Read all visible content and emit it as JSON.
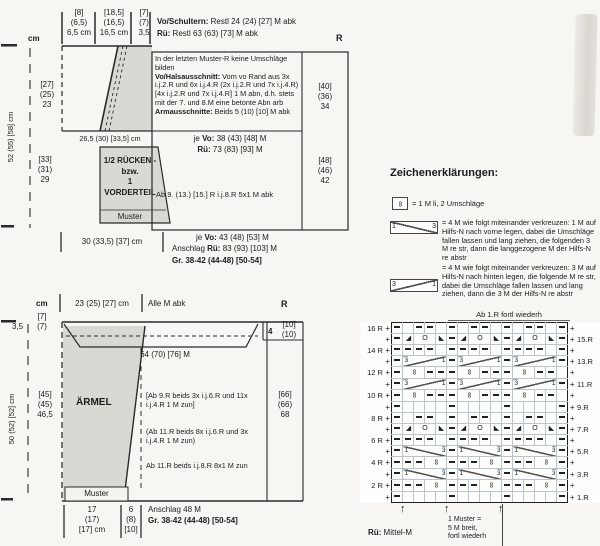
{
  "back": {
    "cm": "cm",
    "measure1": "[8]\n(6,5)\n6,5 cm",
    "measure2": "[18,5]\n(16,5)\n16,5 cm",
    "measure3": "[7]\n(7)\n3,5",
    "shoulder1_b": "Vo/Schultern:",
    "shoulder1_t": " Restl 24 (24) [27] M abk",
    "shoulder2_b": "Rü:",
    "shoulder2_t": " Restl 63 (63) [73] M abk",
    "r_header": "R",
    "rows_upper": "[27]\n(25)\n23",
    "rows_lower": "[33]\n(31)\n29",
    "side_cm": "52 (55) [58] cm",
    "mid_width": "26,5 (30) [33,5] cm",
    "piece_label": "1/2 RÜCKEN -\nbzw.\n1 VORDERTEIL",
    "muster": "Muster",
    "note1": "In der letzten Muster-R keine Umschläge bilden",
    "note2_b": "Vo/Halsausschnitt:",
    "note2_t": " Vom vo Rand aus 3x i.j.2.R und 6x i.j.4.R (2x i.j.2.R und 7x i.j.4.R) [4x i.j.2.R und 7x i.j.4.R] 1 M abn, d.h. stets mit der 7. und 8.M eine betonte Abn arb",
    "note3_b": "Armausschnitte:",
    "note3_t": " Beids 5 (10) [10] M abk",
    "counts_upper": "[40]\n(36)\n34",
    "sts_vo_pre": "je ",
    "sts_vo_b": "Vo:",
    "sts_vo_t": " 38 (43) [48] M",
    "sts_rue_b": "Rü:",
    "sts_rue_t": " 73 (83) [93] M",
    "bindoff_line": "Ab 9. (13.) [15.] R i.j.8.R 5x1 M abk",
    "counts_lower": "[48]\n(46)\n42",
    "bottom_width": "30 (33,5) [37] cm",
    "cast_vo_pre": "je ",
    "cast_vo_b": "Vo:",
    "cast_vo_t": " 43 (48) [53] M",
    "cast_rue_pre": "Anschlag  ",
    "cast_rue_b": "Rü:",
    "cast_rue_t": " 83 (93) [103] M",
    "sizes": "Gr. 38-42 (44-48) [50-54]"
  },
  "sleeve": {
    "cm": "cm",
    "top_width": "23 (25) [27] cm",
    "alle_abk": "Alle M abk",
    "r_header": "R",
    "rows_top_left": "[7]\n(7)",
    "rows_top_left2": "3,5",
    "rows_top_right_a": "4",
    "rows_top_right_b": "[10]\n(10)",
    "notch_sts": "64 (70) [76] M",
    "piece_label": "ÄRMEL",
    "side_cm": "50 (52) [52] cm",
    "rows_left": "[45]\n(45)\n46,5",
    "inc1": "[Ab 9.R beids 3x i.j.6.R und 11x i.j.4.R 1 M zun]",
    "inc2": "(Ab 11.R beids 8x i.j.6.R und 3x i.j.4.R 1 M zun)",
    "inc3": "Ab 11.R beids i.j.8.R 8x1 M zun",
    "counts": "[66]\n(66)\n68",
    "muster": "Muster",
    "bottom_width": "17\n(17)\n[17] cm",
    "bottom_rows": "6\n(8)\n[10]",
    "anschlag": "Anschlag 48 M",
    "sizes": "Gr. 38-42 (44-48) [50-54]"
  },
  "legend": {
    "heading": "Zeichenerklärungen:",
    "sym_oo": "∞",
    "sym2_l": "1",
    "sym2_r": "3",
    "sym3_l": "3",
    "sym3_r": "1",
    "item1_text": "= 1 M li, 2 Umschläge",
    "item2_text": "= 4 M wie folgt miteinander verkreuzen:\n1 M auf Hilfs-N nach vorne legen, dabei die Umschläge fallen lassen und lang ziehen, die folgenden 3 M re str, dann die langgezogene M der Hilfs-N re abstr",
    "item3_text": "= 4 M wie folgt miteinander verkreuzen:\n3 M auf Hilfs-N nach hinten legen, die folgende M re str, dabei die Umschläge fallen lassen und lang ziehen, dann die 3 M der Hilfs-N re abstr"
  },
  "chart_data": {
    "type": "table",
    "title": "Ab 1.R fortl wiederh",
    "plus": "+",
    "palette": [
      "#cf6da8",
      "#5fc7c9",
      "#8ec96d",
      "#d4c558"
    ],
    "left_labels": [
      "16 R",
      "",
      "14 R",
      "",
      "12 R",
      "",
      "10 R",
      "",
      "8 R",
      "",
      "6 R",
      "",
      "4 R",
      "",
      "2 R",
      ""
    ],
    "right_labels": [
      "",
      "15.R",
      "",
      "13.R",
      "",
      "11.R",
      "",
      "9.R",
      "",
      "7.R",
      "",
      "5.R",
      "",
      "3.R",
      "",
      "1.R"
    ],
    "rows": [
      [
        "-",
        "",
        "-",
        "-",
        "",
        "-",
        "",
        "-",
        "-",
        "",
        "-",
        "",
        "-",
        "-",
        "",
        "-"
      ],
      [
        "-",
        "tl",
        "o2",
        "tr",
        "-",
        "tl",
        "o2",
        "tr",
        "-",
        "tl",
        "o2",
        "tr",
        "-"
      ],
      [
        "-",
        "-",
        "-",
        "-",
        "",
        "-",
        "-",
        "-",
        "-",
        "",
        "-",
        "-",
        "-",
        "-",
        "",
        "-"
      ],
      [
        "-",
        "c31",
        "-",
        "c31",
        "-",
        "c31",
        "-"
      ],
      [
        "-",
        "oo2",
        "-",
        "-",
        "-",
        "oo2",
        "-",
        "-",
        "-",
        "oo2",
        "-",
        "-",
        ""
      ],
      [
        "-",
        "c31",
        "-",
        "c31",
        "-",
        "c31",
        "-"
      ],
      [
        "-",
        "oo2",
        "-",
        "-",
        "-",
        "oo2",
        "-",
        "-",
        "-",
        "oo2",
        "-",
        "-",
        ""
      ],
      [
        "-",
        "",
        "",
        "",
        "",
        "-",
        "",
        "",
        "",
        "",
        "-",
        "",
        "",
        "",
        "",
        "-"
      ],
      [
        "-",
        "",
        "-",
        "-",
        "",
        "-",
        "",
        "-",
        "-",
        "",
        "-",
        "",
        "-",
        "-",
        "",
        "-"
      ],
      [
        "-",
        "tl",
        "o2",
        "tr",
        "-",
        "tl",
        "o2",
        "tr",
        "-",
        "tl",
        "o2",
        "tr",
        "-"
      ],
      [
        "-",
        "-",
        "-",
        "-",
        "",
        "-",
        "-",
        "-",
        "-",
        "",
        "-",
        "-",
        "-",
        "-",
        "",
        "-"
      ],
      [
        "-",
        "c13",
        "-",
        "c13",
        "-",
        "c13",
        "-"
      ],
      [
        "-",
        "-",
        "-",
        "oo2",
        "-",
        "-",
        "-",
        "oo2",
        "-",
        "-",
        "-",
        "oo2",
        "-"
      ],
      [
        "-",
        "c13",
        "-",
        "c13",
        "-",
        "c13",
        "-"
      ],
      [
        "-",
        "-",
        "-",
        "oo2",
        "-",
        "-",
        "-",
        "oo2",
        "-",
        "-",
        "-",
        "oo2",
        "-"
      ],
      [
        "-",
        "",
        "",
        "",
        "",
        "-",
        "",
        "",
        "",
        "",
        "-",
        "",
        "",
        "",
        "",
        "-"
      ]
    ],
    "annotations": {
      "footer_left_b": "Rü:",
      "footer_left_t": " Mittel-M",
      "footer_repeat": "1 Muster =\n5 M breit,\nfortl wiederh"
    }
  }
}
